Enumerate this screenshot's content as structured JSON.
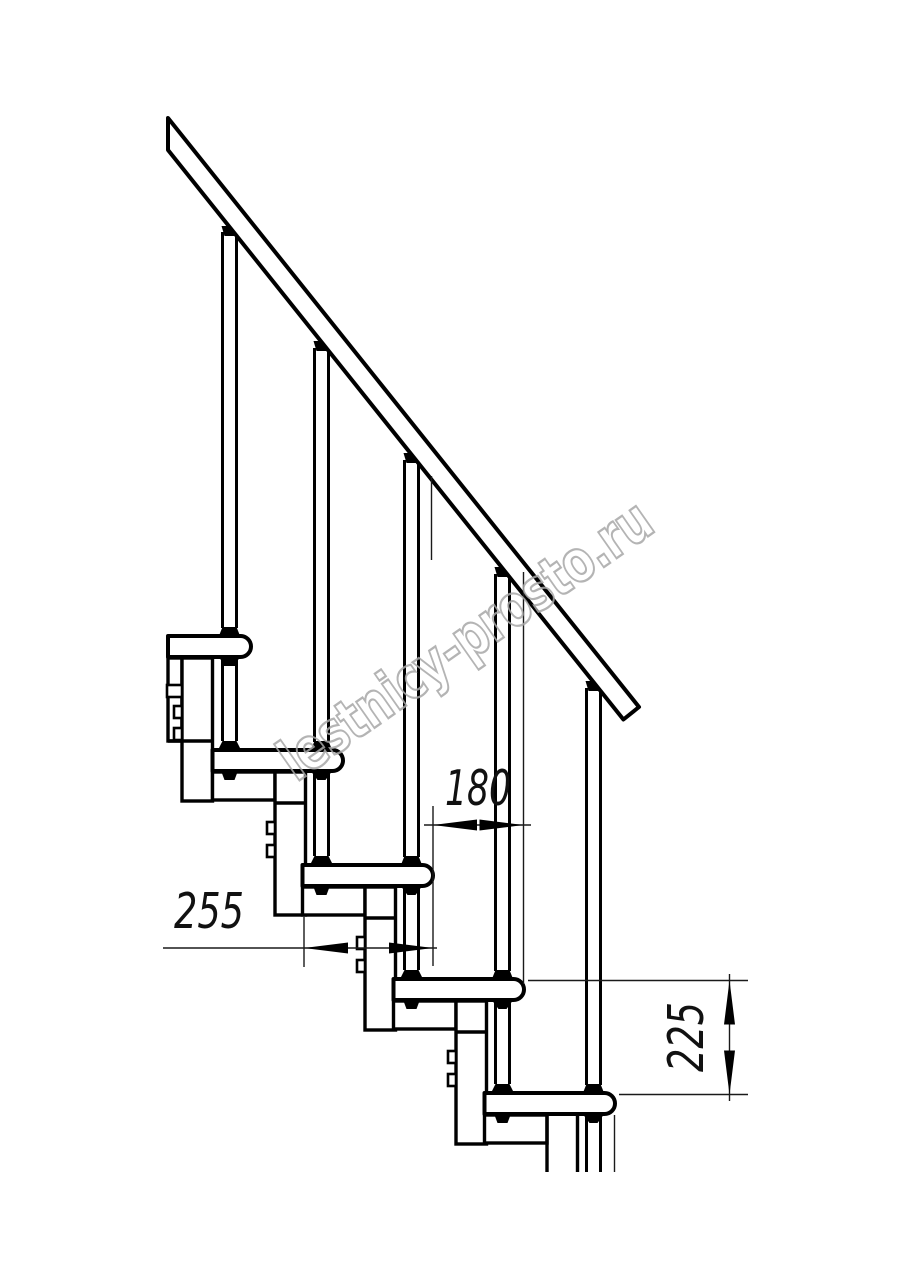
{
  "watermark": {
    "text": "lestnicy-prosto.ru",
    "color": "#a8a8a8"
  },
  "dimensions": {
    "step_run": {
      "value": "180"
    },
    "tread_depth": {
      "value": "255"
    },
    "step_rise": {
      "value": "225"
    }
  },
  "drawing": {
    "line_color": "#000000",
    "background": "#ffffff"
  }
}
